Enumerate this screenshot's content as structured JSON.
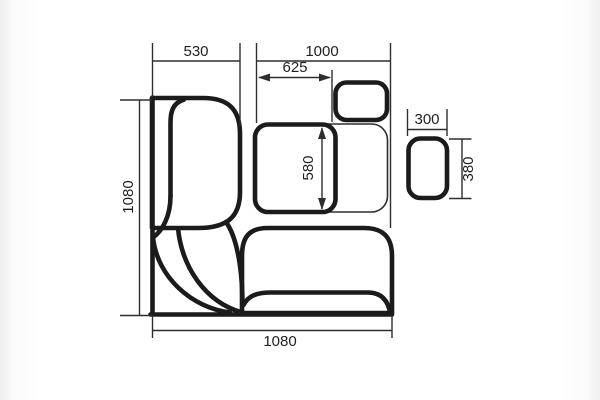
{
  "drawing": {
    "type": "furniture-plan-technical-drawing",
    "dimensions": {
      "bench_left_width": "530",
      "table_zone_width": "1000",
      "table_width": "625",
      "table_depth": "580",
      "left_side_depth": "1080",
      "bottom_side_width": "1080",
      "stool_width": "300",
      "stool_depth": "380"
    },
    "colors": {
      "ink": "#1b1b1b",
      "thin_line": "#2e2e2e",
      "background": "#ffffff"
    }
  }
}
